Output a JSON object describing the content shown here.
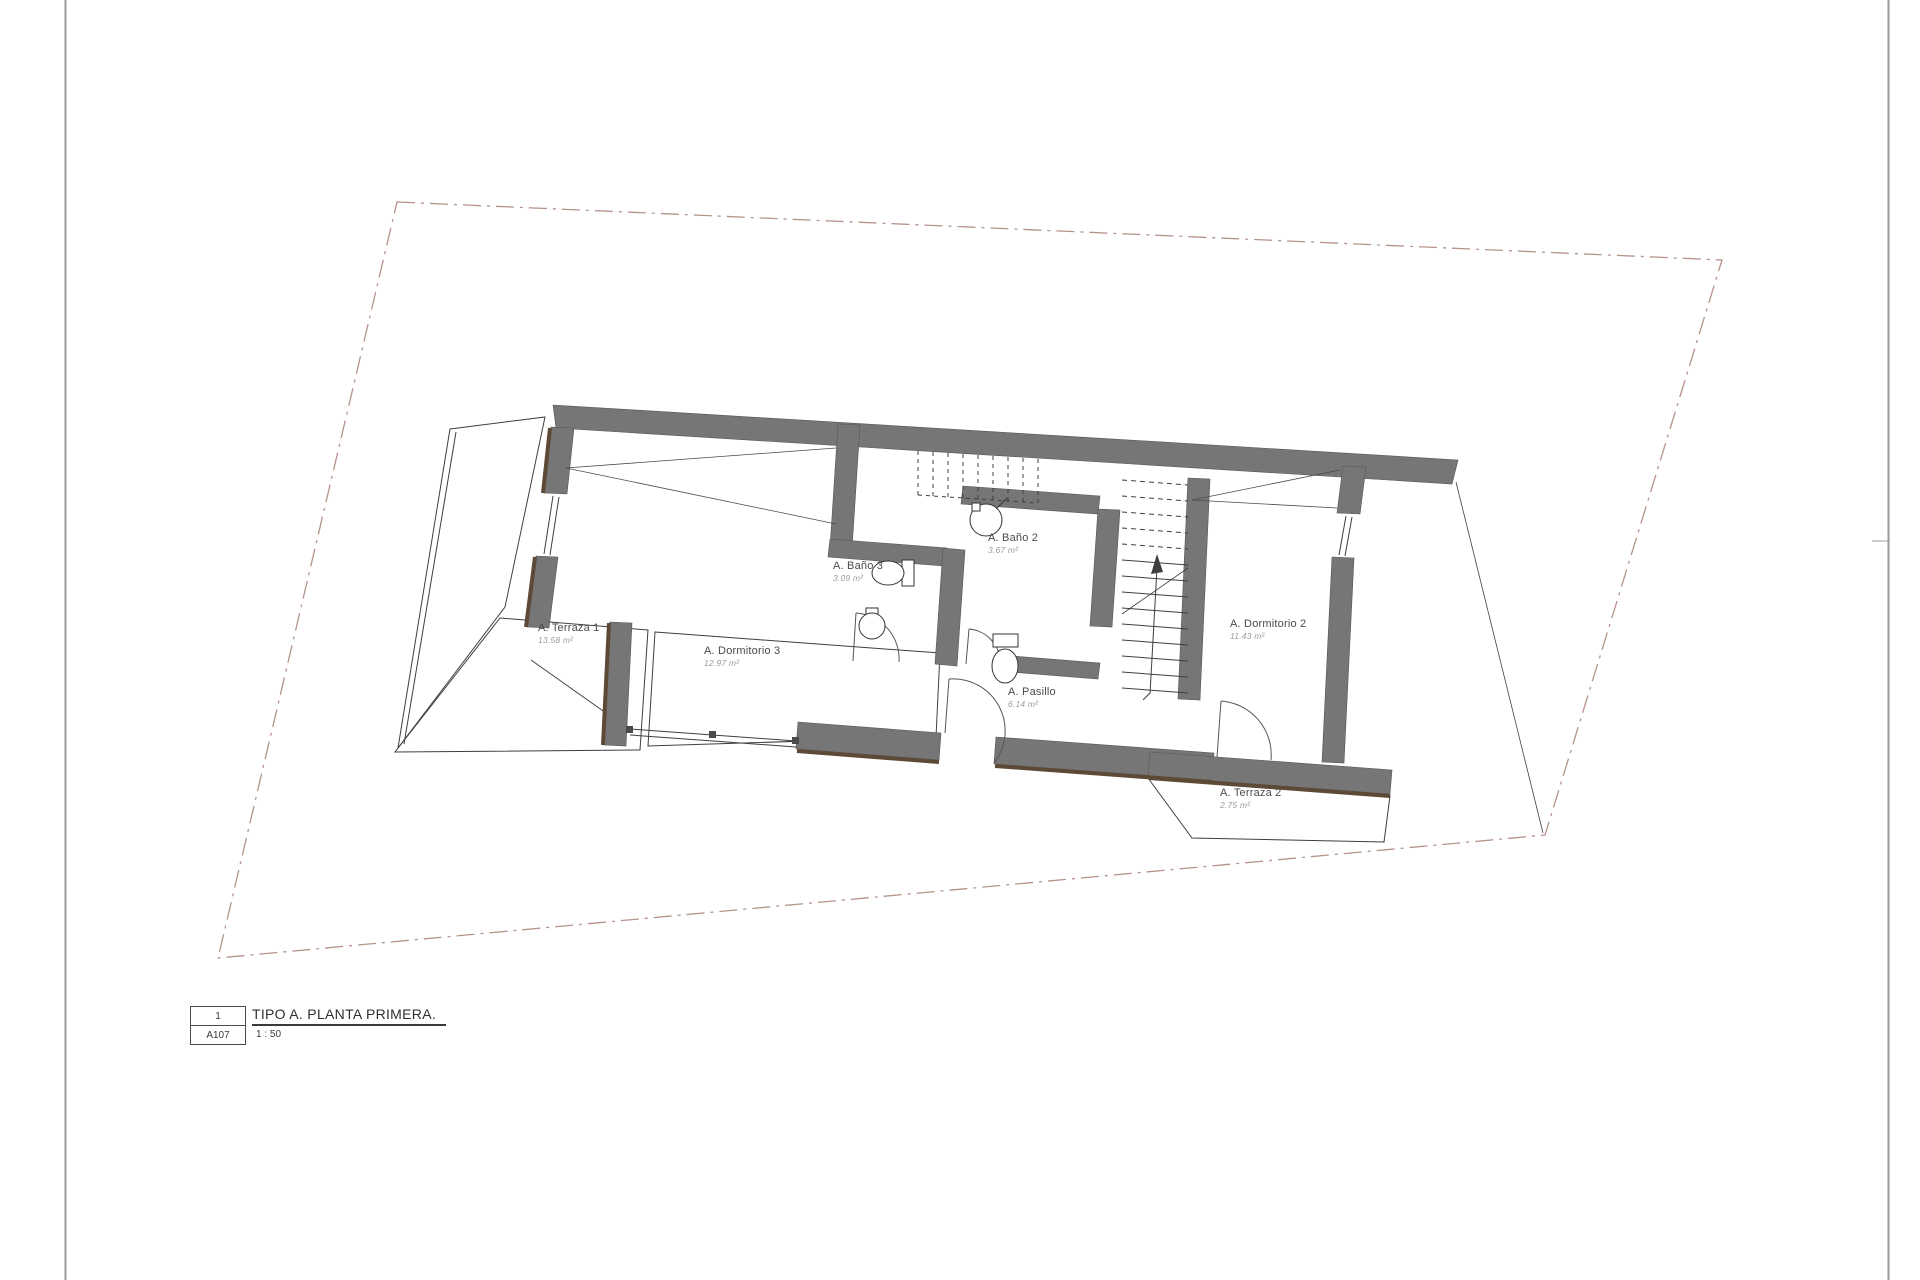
{
  "title_block": {
    "sheet_number": "1",
    "sheet_code": "A107",
    "drawing_title": "TIPO A. PLANTA PRIMERA.",
    "scale": "1 : 50"
  },
  "rooms": [
    {
      "name": "A. Terraza 1",
      "area": "13.58 m²"
    },
    {
      "name": "A. Dormitorio 3",
      "area": "12.97 m²"
    },
    {
      "name": "A. Baño 3",
      "area": "3.09 m²"
    },
    {
      "name": "A. Baño 2",
      "area": "3.67 m²"
    },
    {
      "name": "A. Pasillo",
      "area": "6.14 m²"
    },
    {
      "name": "A. Dormitorio 2",
      "area": "11.43 m²"
    },
    {
      "name": "A. Terraza 2",
      "area": "2.75 m²"
    }
  ],
  "colors": {
    "wall": "#767676",
    "wall_accent": "#5d4a36",
    "line": "#3f3f3f",
    "site_boundary": "#b5938a",
    "page_border": "#9b9b9b",
    "label_text": "#4a4a4a",
    "area_text": "#9a9a9a"
  }
}
